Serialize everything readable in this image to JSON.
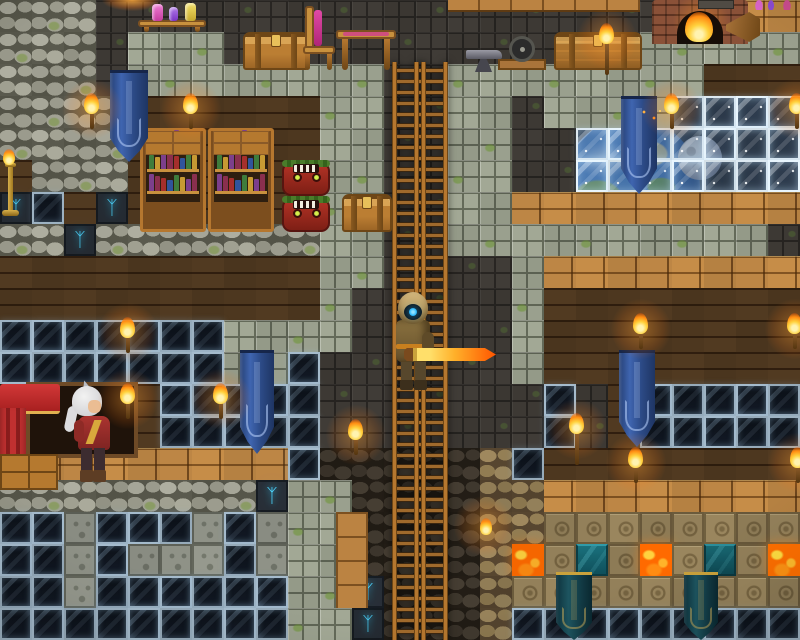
{
  "scene": {
    "width": 800,
    "height": 640,
    "tile_size": 32,
    "cols": 25,
    "rows": 20,
    "background": "#161008"
  },
  "palette": {
    "rune_glow": "#49c9ef",
    "lava": "#ff6a00",
    "banner_blue": "#3f65b0",
    "banner_dark_teal": "#1d5560",
    "flame_orange": "#ff8c12",
    "visor_cyan": "#35c0ff",
    "sword_orange": "#ff5500",
    "wood_light": "#b5803f",
    "wood_dark": "#4a3420",
    "stone_light": "#9aa08e",
    "stone_dark": "#3d3934"
  },
  "rune_glyph": "ᛉ",
  "book_colors": [
    "#a52f2c",
    "#30549c",
    "#3f7c3c",
    "#c79a33",
    "#7c3f8c",
    "#8a2f4e"
  ],
  "tile_legend": {
    "C": {
      "name": "tile-cobblestone",
      "interactable": "true"
    },
    "D": {
      "name": "tile-dark-stone-brick",
      "interactable": "true"
    },
    "S": {
      "name": "tile-stone-brick",
      "interactable": "true"
    },
    "W": {
      "name": "tile-dark-wood-wall",
      "interactable": "true"
    },
    "w": {
      "name": "tile-wood-planks",
      "interactable": "true"
    },
    "G": {
      "name": "tile-dark-window",
      "interactable": "true"
    },
    "E": {
      "name": "tile-sky-window",
      "interactable": "true"
    },
    "R": {
      "name": "tile-runestone",
      "interactable": "true"
    },
    "L": {
      "name": "tile-lava",
      "interactable": "true"
    },
    "T": {
      "name": "tile-teal-block",
      "interactable": "true"
    },
    "B": {
      "name": "tile-sandstone-block",
      "interactable": "true"
    },
    "s": {
      "name": "tile-limestone-block",
      "interactable": "true"
    },
    "o": {
      "name": "tile-dark-cobble",
      "interactable": "true"
    },
    "c": {
      "name": "tile-tan-cobble",
      "interactable": "true"
    }
  },
  "tilemap": [
    "CCCDDDDDDDDDDDDDDDDDDDDww",
    "CCCDSSSDDDDDDDDDDDDDSSSSS",
    "CCCDSSSSSSSSDDSSSSSSSSWWW",
    "CCCCWWWWWWSSDDSSDSSSSEEEE",
    "CCCCWWWWWWSSDDSSDDEEEEEEE",
    "WCCCWWWWWWSSDDSSDDEEEEEEE",
    "RGWRWWWWWWSSDDSSwwwwwwwww",
    "CCRCCCCCCCSSDDSSSSSSSSSSD",
    "WWWWWWWWWWSSDDDDSwwwwwwww",
    "WWWWWWWWWWSDDDDDSWWWWWWWW",
    "GGGGGGGSSSSDDDDDSWWWWWWWW",
    "GGGGGGGSSGDDDDDDSWWWWWWWW",
    "WWWWWGGGGGDDDDDDDGDWGGGGG",
    "WWWWWGGGGGDDDDDDDGDWGGGGG",
    "wwwwwwwwwGooooocGWWWWWWWW",
    "CCCCCCCCRSSooooccwwwwwwww",
    "GGsGGGsGsSSooooccBBBBBBBB",
    "GGsGsssGsSSoooocLBTBLBTBL",
    "GGsGGGGGGSSRooocBBBBBBBBB",
    "GGGGGGGGGSSRooocGGGGGGGGG"
  ],
  "bg_sprites": [
    {
      "type": "earth",
      "name": "earth-planet",
      "x": 562,
      "y": 118,
      "w": 138,
      "h": 138,
      "interactable": "false"
    },
    {
      "type": "moon",
      "name": "moon",
      "x": 678,
      "y": 136,
      "w": 44,
      "h": 44,
      "interactable": "false"
    }
  ],
  "sprites": [
    {
      "type": "ladder",
      "name": "ladder",
      "x": 392,
      "y": 62,
      "w": 56,
      "h": 578,
      "interactable": "true"
    },
    {
      "type": "woodstrip",
      "name": "wood-strip",
      "x": 448,
      "y": 0,
      "w": 192,
      "h": 12,
      "interactable": "false"
    },
    {
      "type": "woodcol",
      "name": "wood-column",
      "x": 336,
      "y": 512,
      "w": 32,
      "h": 96,
      "interactable": "true"
    },
    {
      "type": "brazier",
      "name": "brazier-glow",
      "x": 94,
      "y": 0,
      "w": 76,
      "h": 14,
      "interactable": "true"
    },
    {
      "type": "potiontable",
      "name": "potion-table",
      "x": 138,
      "y": 0,
      "w": 68,
      "h": 32,
      "interactable": "true"
    },
    {
      "type": "chest",
      "name": "wooden-chest",
      "x": 243,
      "y": 32,
      "w": 66,
      "h": 38,
      "interactable": "true"
    },
    {
      "type": "chair",
      "name": "chair",
      "x": 301,
      "y": 6,
      "w": 36,
      "h": 64,
      "interactable": "true"
    },
    {
      "type": "table",
      "name": "table",
      "x": 336,
      "y": 30,
      "w": 60,
      "h": 40,
      "interactable": "true"
    },
    {
      "type": "anvil",
      "name": "anvil",
      "x": 466,
      "y": 46,
      "w": 36,
      "h": 26,
      "interactable": "true"
    },
    {
      "type": "grinder",
      "name": "grinding-wheel",
      "x": 498,
      "y": 36,
      "w": 48,
      "h": 34,
      "interactable": "true"
    },
    {
      "type": "chest",
      "variant": "big",
      "name": "large-chest",
      "x": 554,
      "y": 32,
      "w": 88,
      "h": 38,
      "interactable": "true"
    },
    {
      "type": "fireplace",
      "name": "fireplace",
      "x": 652,
      "y": 0,
      "w": 96,
      "h": 44,
      "interactable": "true"
    },
    {
      "type": "bellows",
      "name": "bellows",
      "x": 726,
      "y": 12,
      "w": 34,
      "h": 30,
      "interactable": "true"
    },
    {
      "type": "shelfitems",
      "name": "shelf-potions",
      "x": 750,
      "y": 0,
      "w": 50,
      "h": 10,
      "interactable": "false"
    },
    {
      "type": "bookshelf",
      "name": "bookshelf",
      "x": 140,
      "y": 128,
      "w": 66,
      "h": 104,
      "interactable": "true"
    },
    {
      "type": "bookshelf",
      "name": "bookshelf",
      "x": 208,
      "y": 128,
      "w": 66,
      "h": 104,
      "interactable": "true"
    },
    {
      "type": "totem",
      "name": "tiki-totem",
      "x": 280,
      "y": 160,
      "w": 54,
      "h": 72,
      "interactable": "true"
    },
    {
      "type": "chest",
      "name": "wooden-chest",
      "x": 342,
      "y": 194,
      "w": 50,
      "h": 38,
      "interactable": "true"
    },
    {
      "type": "candelabra",
      "name": "candelabra",
      "x": 0,
      "y": 156,
      "w": 22,
      "h": 60,
      "interactable": "true"
    },
    {
      "type": "bed",
      "name": "canopy-bed",
      "x": 0,
      "y": 382,
      "w": 140,
      "h": 108,
      "interactable": "true"
    },
    {
      "type": "npc",
      "name": "npc-character",
      "x": 54,
      "y": 380,
      "w": 86,
      "h": 112,
      "interactable": "true"
    },
    {
      "type": "banner",
      "name": "blue-banner",
      "x": 110,
      "y": 70,
      "w": 38,
      "h": 92,
      "interactable": "true"
    },
    {
      "type": "banner",
      "name": "blue-banner",
      "x": 240,
      "y": 350,
      "w": 34,
      "h": 104,
      "interactable": "true"
    },
    {
      "type": "banner",
      "name": "blue-banner",
      "x": 621,
      "y": 96,
      "w": 36,
      "h": 98,
      "interactable": "true"
    },
    {
      "type": "banner",
      "name": "blue-banner",
      "x": 619,
      "y": 350,
      "w": 36,
      "h": 97,
      "interactable": "true"
    },
    {
      "type": "banner",
      "variant": "dark",
      "name": "dark-banner",
      "x": 556,
      "y": 572,
      "w": 36,
      "h": 68,
      "interactable": "true"
    },
    {
      "type": "banner",
      "variant": "dark",
      "name": "dark-banner",
      "x": 684,
      "y": 572,
      "w": 34,
      "h": 68,
      "interactable": "true"
    },
    {
      "type": "torch",
      "name": "wall-torch",
      "x": 83,
      "y": 94,
      "w": 18,
      "h": 38,
      "interactable": "true"
    },
    {
      "type": "torch",
      "name": "wall-torch",
      "x": 182,
      "y": 94,
      "w": 18,
      "h": 38,
      "interactable": "true"
    },
    {
      "type": "torch",
      "name": "wall-torch",
      "x": 119,
      "y": 318,
      "w": 18,
      "h": 38,
      "interactable": "true"
    },
    {
      "type": "torch",
      "name": "wall-torch",
      "x": 119,
      "y": 384,
      "w": 18,
      "h": 38,
      "interactable": "true"
    },
    {
      "type": "torch",
      "name": "wall-torch",
      "x": 212,
      "y": 384,
      "w": 18,
      "h": 38,
      "interactable": "true"
    },
    {
      "type": "torch",
      "name": "wall-torch",
      "x": 347,
      "y": 420,
      "w": 18,
      "h": 38,
      "interactable": "true"
    },
    {
      "type": "torch",
      "variant": "big",
      "name": "wall-torch",
      "x": 598,
      "y": 24,
      "w": 20,
      "h": 48,
      "interactable": "true"
    },
    {
      "type": "torch",
      "name": "wall-torch",
      "x": 663,
      "y": 94,
      "w": 18,
      "h": 38,
      "interactable": "true"
    },
    {
      "type": "torch",
      "name": "wall-torch",
      "x": 788,
      "y": 94,
      "w": 18,
      "h": 38,
      "interactable": "true"
    },
    {
      "type": "torch",
      "name": "wall-torch",
      "x": 632,
      "y": 314,
      "w": 18,
      "h": 38,
      "interactable": "true"
    },
    {
      "type": "torch",
      "name": "wall-torch",
      "x": 786,
      "y": 314,
      "w": 18,
      "h": 38,
      "interactable": "true"
    },
    {
      "type": "torch",
      "variant": "big",
      "name": "wall-torch",
      "x": 568,
      "y": 414,
      "w": 20,
      "h": 68,
      "interactable": "true"
    },
    {
      "type": "torch",
      "name": "wall-torch",
      "x": 627,
      "y": 448,
      "w": 18,
      "h": 40,
      "interactable": "true"
    },
    {
      "type": "torch",
      "name": "wall-torch",
      "x": 789,
      "y": 448,
      "w": 18,
      "h": 40,
      "interactable": "true"
    },
    {
      "type": "ember",
      "name": "floating-ember",
      "x": 478,
      "y": 514,
      "w": 16,
      "h": 26,
      "interactable": "false"
    },
    {
      "type": "sparks",
      "name": "sparks",
      "x": 640,
      "y": 108,
      "w": 24,
      "h": 18,
      "interactable": "false"
    },
    {
      "type": "player",
      "name": "player-character",
      "x": 384,
      "y": 292,
      "w": 112,
      "h": 104,
      "interactable": "true"
    },
    {
      "type": "vignette",
      "name": "vignette",
      "x": 0,
      "y": 0,
      "w": 800,
      "h": 640,
      "interactable": "false"
    }
  ]
}
